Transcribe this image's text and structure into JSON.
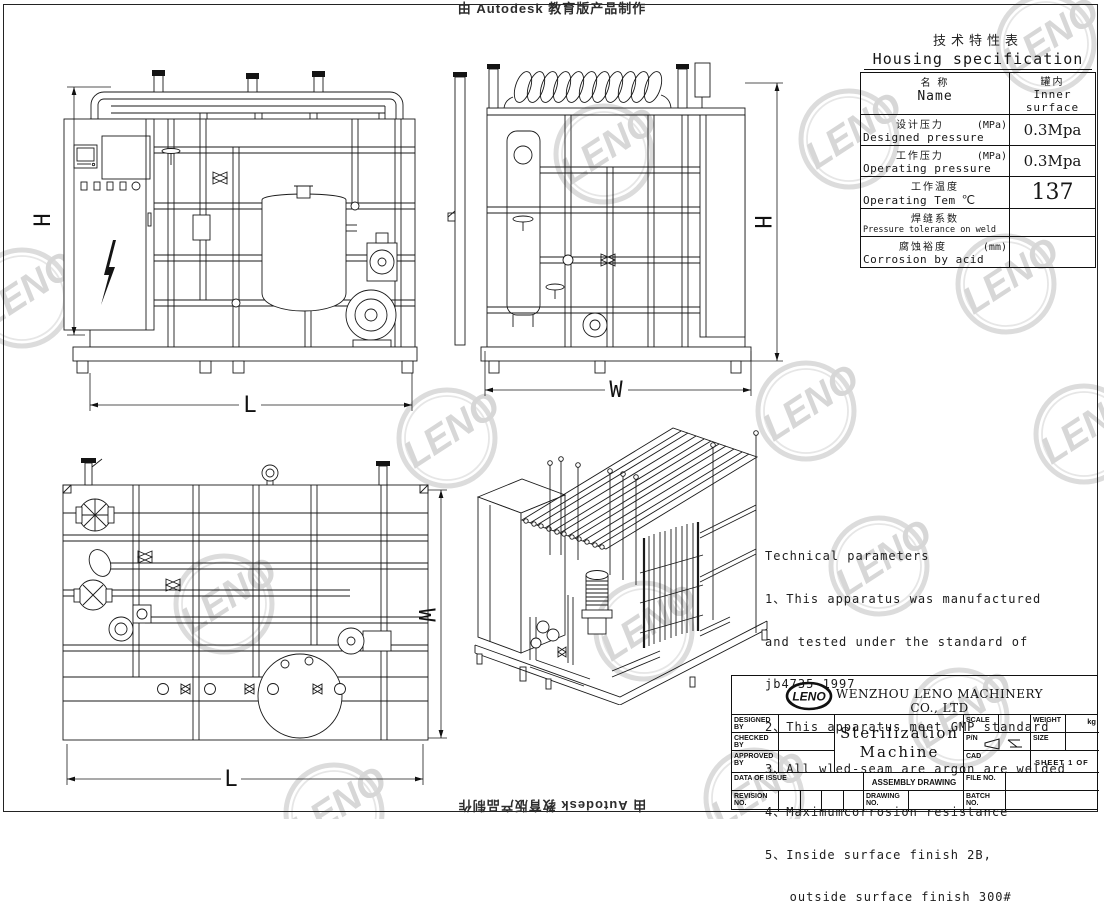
{
  "page": {
    "top_watermark": "由 Autodesk 教育版产品制作",
    "bottom_watermark": "由 Autodesk 教育版产品制作",
    "brand_watermark": "LENO"
  },
  "views": {
    "front": {
      "h_label": "H",
      "l_label": "L"
    },
    "side": {
      "w_label": "W",
      "h_label": "H"
    },
    "plan": {
      "w_label": "W",
      "l_label": "L"
    }
  },
  "spec_table": {
    "title_zh": "技术特性表",
    "title_en": "Housing specification",
    "header": {
      "name_zh": "名    称",
      "name_en": "Name",
      "value_zh": "罐内",
      "value_en": "Inner surface"
    },
    "rows": [
      {
        "zh": "设计压力",
        "unit": "(MPa)",
        "en": "Designed pressure",
        "value": "0.3Mpa"
      },
      {
        "zh": "工作压力",
        "unit": "(MPa)",
        "en": "Operating pressure",
        "value": "0.3Mpa"
      },
      {
        "zh": "工作温度",
        "unit": "℃",
        "en": "Operating Tem",
        "value": "137"
      },
      {
        "zh": "焊缝系数",
        "unit": "",
        "en": "Pressure tolerance on weld",
        "value": ""
      },
      {
        "zh": "腐蚀裕度",
        "unit": "(mm)",
        "en": "Corrosion by acid",
        "value": ""
      }
    ]
  },
  "tech_params": {
    "lines": [
      "Technical parameters",
      "1、This apparatus was manufactured",
      "and tested under the standard of",
      "jb4735-1997",
      "2、This apparatus meet GMP standard",
      "3、All wled-seam are argon are welded",
      "4、Maximumcorrosion resistance",
      "5、Inside surface finish 2B,",
      "   outside surface finish 300#"
    ]
  },
  "title_block": {
    "logo_text": "LENO",
    "company": "WENZHOU LENO MACHINERY CO., LTD",
    "drawing_title_line1": "Sterilization",
    "drawing_title_line2": "Machine",
    "labels": {
      "designed_by": "DESIGNED BY",
      "checked_by": "CHECKED BY",
      "approved_by": "APPROVED BY",
      "data_of_issue": "DATA OF ISSUE",
      "revision_no": "REVISION NO.",
      "scale": "SCALE",
      "weight": "WEIGHT",
      "weight_unit": "kg",
      "pn": "P/N",
      "size": "SIZE",
      "cad": "CAD",
      "sheet": "SHEET 1  OF",
      "assembly_drawing": "ASSEMBLY DRAWING",
      "file_no": "FILE NO.",
      "drawing_no": "DRAWING NO.",
      "batch_no": "BATCH NO."
    }
  }
}
